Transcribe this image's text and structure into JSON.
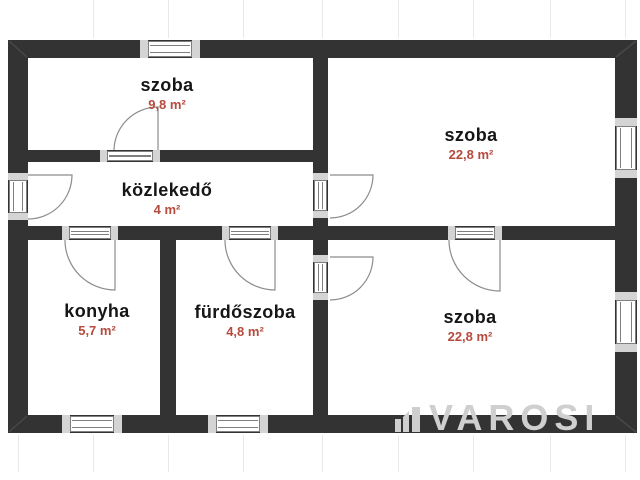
{
  "plan": {
    "watermark": {
      "text": "VAROSI",
      "logo_icon": "building-skyline"
    },
    "colors": {
      "wall": "#333333",
      "room_name": "#161616",
      "area": "#b54a3d",
      "door": "#8c8c8c",
      "window_border": "#7f7f7f",
      "window_cap": "#d4d4d4",
      "guide": "#e8e8e8",
      "watermark": "#cfcfcf"
    },
    "rooms": [
      {
        "id": "szoba-1",
        "name": "szoba",
        "area": "9,8 m²"
      },
      {
        "id": "szoba-2",
        "name": "szoba",
        "area": "22,8 m²"
      },
      {
        "id": "kozlekedo",
        "name": "közlekedő",
        "area": "4 m²"
      },
      {
        "id": "konyha",
        "name": "konyha",
        "area": "5,7 m²"
      },
      {
        "id": "furdoszoba",
        "name": "fürdőszoba",
        "area": "4,8 m²"
      },
      {
        "id": "szoba-3",
        "name": "szoba",
        "area": "22,8 m²"
      }
    ]
  }
}
